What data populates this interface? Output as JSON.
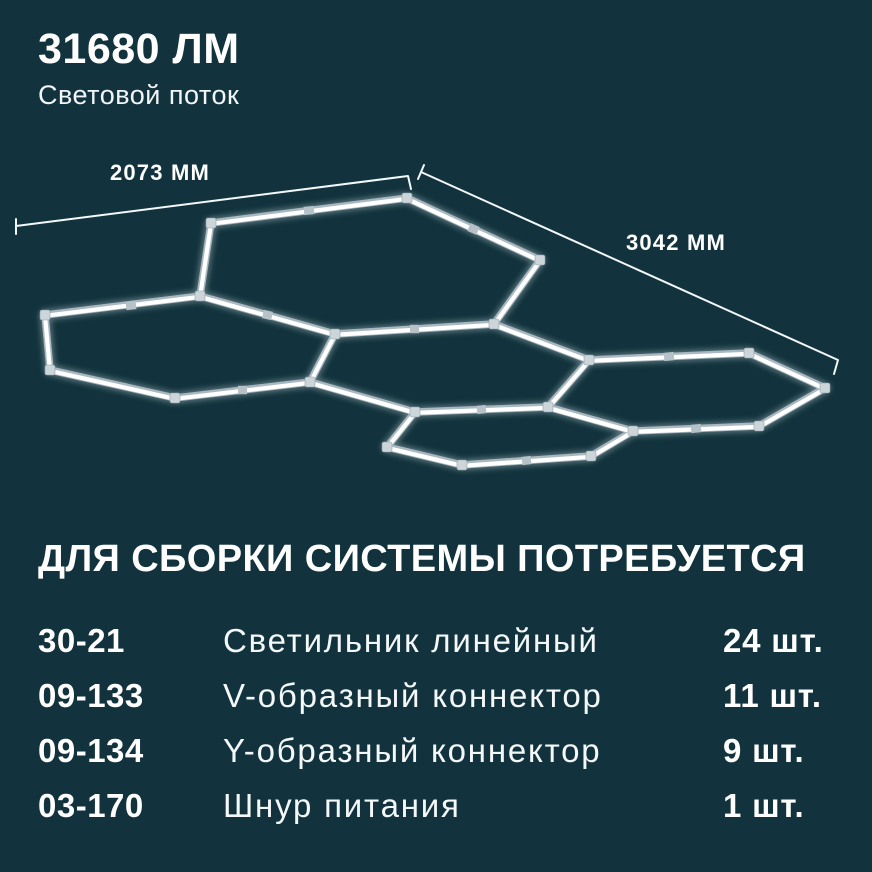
{
  "colors": {
    "background": "#12333d",
    "text": "#ffffff",
    "tube_core": "#ffffff",
    "tube_frame": "#a9b8c0",
    "connector": "#ccd5da"
  },
  "header": {
    "lumens_value": "31680 ЛМ",
    "lumens_caption": "Световой поток"
  },
  "diagram": {
    "type": "hexagonal-led-lighting-system",
    "width_label": "2073 ММ",
    "depth_label": "3042 ММ",
    "hexagon_count": 5
  },
  "parts": {
    "heading": "ДЛЯ СБОРКИ СИСТЕМЫ ПОТРЕБУЕТСЯ",
    "rows": [
      {
        "code": "30-21",
        "name": "Светильник линейный",
        "qty": "24 шт."
      },
      {
        "code": "09-133",
        "name": "V-образный коннектор",
        "qty": "11 шт."
      },
      {
        "code": "09-134",
        "name": "Y-образный коннектор",
        "qty": "9 шт."
      },
      {
        "code": "03-170",
        "name": "Шнур питания",
        "qty": "1 шт."
      }
    ]
  }
}
